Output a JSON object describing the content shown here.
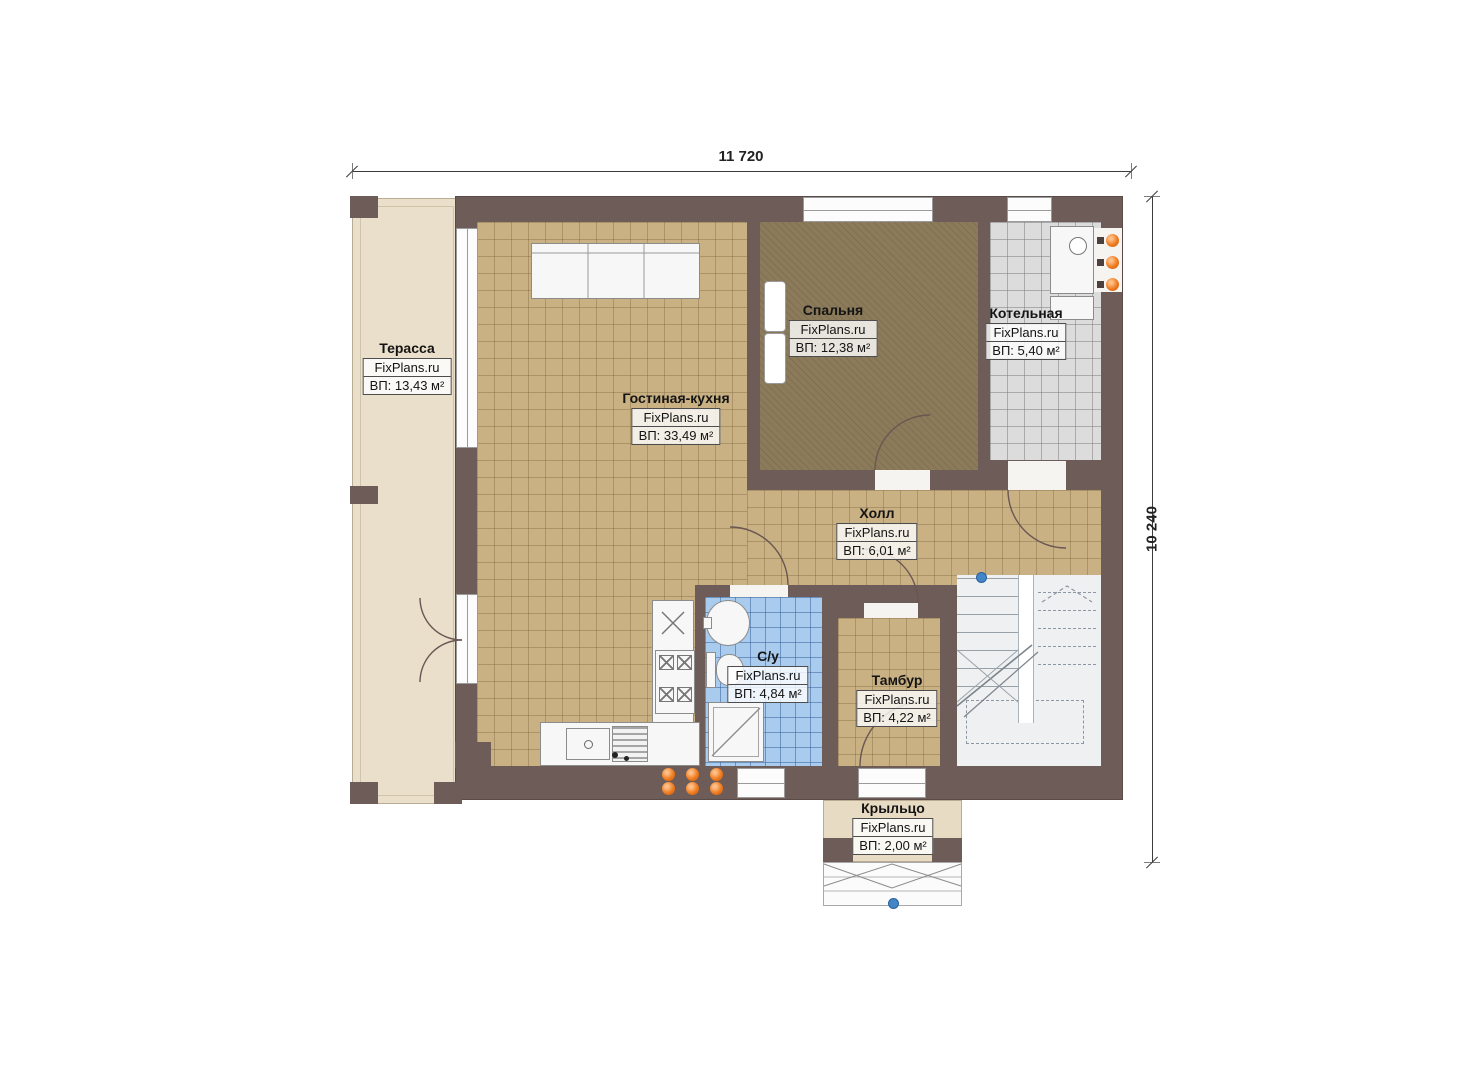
{
  "dimensions": {
    "top": "11 720",
    "right": "10 240"
  },
  "rooms": [
    {
      "key": "terrace",
      "name": "Терасса",
      "brand": "FixPlans.ru",
      "area": "ВП: 13,43 м²"
    },
    {
      "key": "living_kitchen",
      "name": "Гостиная-кухня",
      "brand": "FixPlans.ru",
      "area": "ВП: 33,49 м²"
    },
    {
      "key": "bedroom",
      "name": "Спальня",
      "brand": "FixPlans.ru",
      "area": "ВП: 12,38 м²"
    },
    {
      "key": "boiler",
      "name": "Котельная",
      "brand": "FixPlans.ru",
      "area": "ВП: 5,40 м²"
    },
    {
      "key": "hall",
      "name": "Холл",
      "brand": "FixPlans.ru",
      "area": "ВП: 6,01 м²"
    },
    {
      "key": "bathroom",
      "name": "С/у",
      "brand": "FixPlans.ru",
      "area": "ВП: 4,84 м²"
    },
    {
      "key": "tambour",
      "name": "Тамбур",
      "brand": "FixPlans.ru",
      "area": "ВП: 4,22 м²"
    },
    {
      "key": "porch",
      "name": "Крыльцо",
      "brand": "FixPlans.ru",
      "area": "ВП: 2,00 м²"
    }
  ],
  "colors": {
    "wall": "#6e5c59",
    "floor_tan": "#c9b184",
    "floor_bedroom": "#8c7b5a",
    "floor_boiler": "#dcdcdc",
    "floor_bathroom": "#a9cbee",
    "terrace": "#eadfca",
    "porch": "#e7dbc3",
    "accent_orange": "#ef7b1f",
    "accent_blue": "#4286c8"
  }
}
